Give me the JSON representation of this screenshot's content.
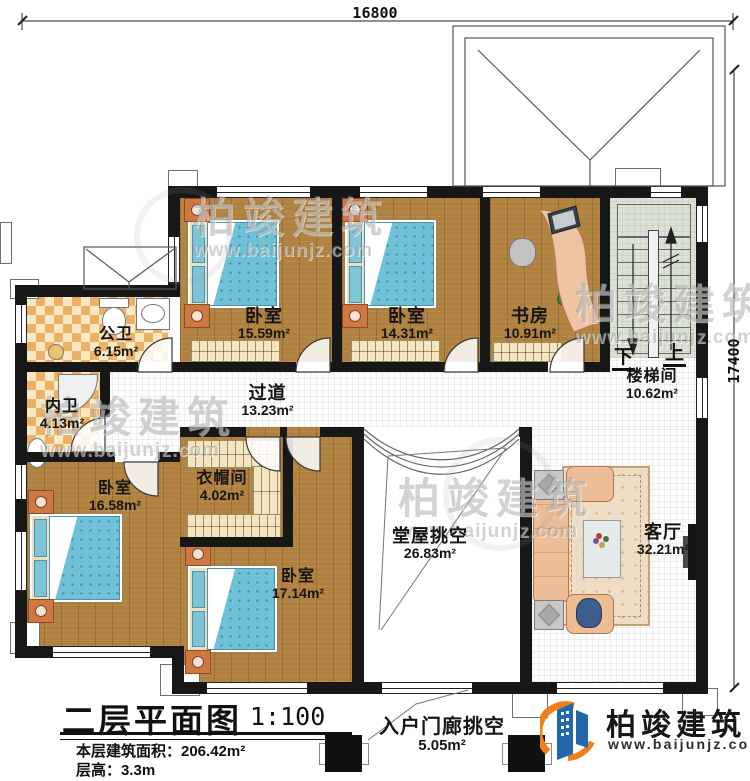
{
  "dimensions": {
    "top": "16800",
    "right": "17400"
  },
  "rooms": {
    "bedroom_top_left": {
      "name": "卧室",
      "area": "15.59m²"
    },
    "bedroom_top_mid": {
      "name": "卧室",
      "area": "14.31m²"
    },
    "study": {
      "name": "书房",
      "area": "10.91m²"
    },
    "stairwell": {
      "name": "楼梯间",
      "area": "10.62m²"
    },
    "public_bath": {
      "name": "公卫",
      "area": "6.15m²"
    },
    "ensuite_bath": {
      "name": "内卫",
      "area": "4.13m²"
    },
    "corridor": {
      "name": "过道",
      "area": "13.23m²"
    },
    "cloakroom": {
      "name": "衣帽间",
      "area": "4.02m²"
    },
    "bedroom_left": {
      "name": "卧室",
      "area": "16.58m²"
    },
    "bedroom_bottom": {
      "name": "卧室",
      "area": "17.14m²"
    },
    "hall_void": {
      "name": "堂屋挑空",
      "area": "26.83m²"
    },
    "living_room": {
      "name": "客厅",
      "area": "32.21m²"
    },
    "porch_void": {
      "name": "入户门廊挑空",
      "area": "5.05m²"
    }
  },
  "stairs": {
    "down": "下",
    "up": "上"
  },
  "title_block": {
    "title": "二层平面图",
    "scale": "1:100",
    "area_line": "本层建筑面积：206.42m²",
    "height_line": "层高：3.3m"
  },
  "brand": {
    "name": "柏竣建筑",
    "url": "www.baijunjz.com",
    "blue": "#2266ab",
    "orange": "#ee7f1d"
  },
  "watermark": {
    "name": "柏竣建筑",
    "url": "www.baijunjz.com"
  }
}
